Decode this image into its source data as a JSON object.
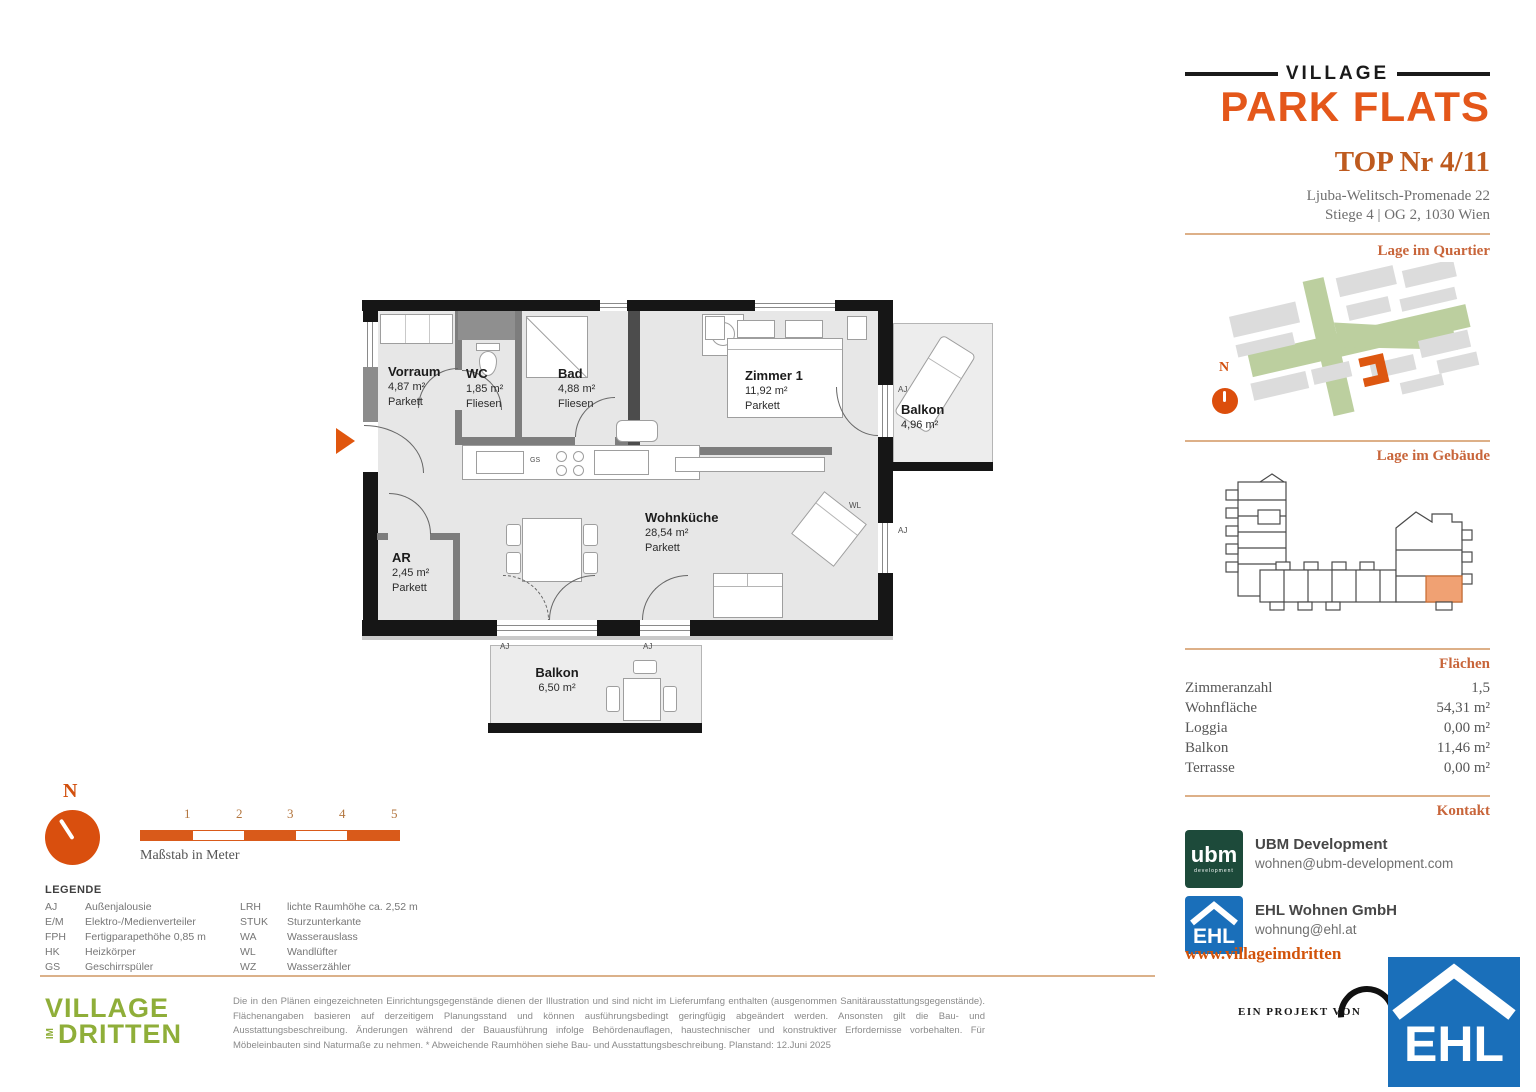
{
  "header": {
    "brand_top": "VILLAGE",
    "brand_main": "PARK FLATS",
    "unit_title": "TOP Nr 4/11",
    "address_line1": "Ljuba-Welitsch-Promenade 22",
    "address_line2": "Stiege 4 | OG 2, 1030 Wien"
  },
  "sections": {
    "quartier": "Lage im Quartier",
    "gebaeude": "Lage im Gebäude",
    "flaechen": "Flächen",
    "kontakt": "Kontakt"
  },
  "compass_label": "N",
  "areas": [
    {
      "label": "Zimmeranzahl",
      "value": "1,5"
    },
    {
      "label": "Wohnfläche",
      "value": "54,31 m²"
    },
    {
      "label": "Loggia",
      "value": "0,00 m²"
    },
    {
      "label": "Balkon",
      "value": "11,46 m²"
    },
    {
      "label": "Terrasse",
      "value": "0,00 m²"
    }
  ],
  "contacts": [
    {
      "name": "UBM Development",
      "email": "wohnen@ubm-development.com"
    },
    {
      "name": "EHL Wohnen GmbH",
      "email": "wohnung@ehl.at"
    }
  ],
  "website": "www.villageimdritten",
  "project_note": "EIN PROJEKT VON",
  "logos": {
    "ubm": "ubm",
    "ubm_sub": "development",
    "ehl": "EHL"
  },
  "floorplan": {
    "rooms": {
      "vorraum": {
        "name": "Vorraum",
        "area": "4,87 m²",
        "floor": "Parkett"
      },
      "wc": {
        "name": "WC",
        "area": "1,85 m²",
        "floor": "Fliesen"
      },
      "bad": {
        "name": "Bad",
        "area": "4,88 m²",
        "floor": "Fliesen"
      },
      "zimmer1": {
        "name": "Zimmer 1",
        "area": "11,92 m²",
        "floor": "Parkett"
      },
      "wohnkueche": {
        "name": "Wohnküche",
        "area": "28,54 m²",
        "floor": "Parkett"
      },
      "ar": {
        "name": "AR",
        "area": "2,45 m²",
        "floor": "Parkett"
      },
      "balkon_ost": {
        "name": "Balkon",
        "area": "4,96 m²"
      },
      "balkon_sued": {
        "name": "Balkon",
        "area": "6,50 m²"
      }
    },
    "tags": {
      "aj": "AJ",
      "wl": "WL",
      "gs": "GS"
    }
  },
  "scalebar": {
    "ticks": [
      "1",
      "2",
      "3",
      "4",
      "5"
    ],
    "caption": "Maßstab in Meter"
  },
  "legend": {
    "title": "LEGENDE",
    "col1": [
      {
        "abbr": "AJ",
        "text": "Außenjalousie"
      },
      {
        "abbr": "E/M",
        "text": "Elektro-/Medienverteiler"
      },
      {
        "abbr": "FPH",
        "text": "Fertigparapethöhe 0,85 m"
      },
      {
        "abbr": "HK",
        "text": "Heizkörper"
      },
      {
        "abbr": "GS",
        "text": "Geschirrspüler"
      }
    ],
    "col2": [
      {
        "abbr": "LRH",
        "text": "lichte Raumhöhe ca. 2,52 m"
      },
      {
        "abbr": "STUK",
        "text": "Sturzunterkante"
      },
      {
        "abbr": "WA",
        "text": "Wasserauslass"
      },
      {
        "abbr": "WL",
        "text": "Wandlüfter"
      },
      {
        "abbr": "WZ",
        "text": "Wasserzähler"
      }
    ]
  },
  "footer": {
    "brand1": "VILLAGE",
    "brand_im": "IM",
    "brand2": "DRITTEN",
    "disclaimer": "Die in den Plänen eingezeichneten Einrichtungsgegenstände dienen der Illustration und sind nicht im Lieferumfang enthalten (ausgenommen Sanitärausstattungsgegenstände). Flächenangaben basieren auf derzeitigem Planungsstand und können ausführungsbedingt geringfügig abgeändert werden. Ansonsten gilt die Bau- und Ausstattungsbeschreibung. Änderungen während der Bauausführung infolge Behördenauflagen, haustechnischer und konstruktiver Erfordernisse vorbehalten. Für Möbeleinbauten sind Naturmaße zu nehmen. * Abweichende Raumhöhen siehe Bau- und Ausstattungsbeschreibung. Planstand: 12.Juni 2025"
  },
  "colors": {
    "accent": "#E0560E",
    "ubm_green": "#1D4A3A",
    "ehl_blue": "#1A6FBA",
    "village_green": "#8FAE39"
  }
}
